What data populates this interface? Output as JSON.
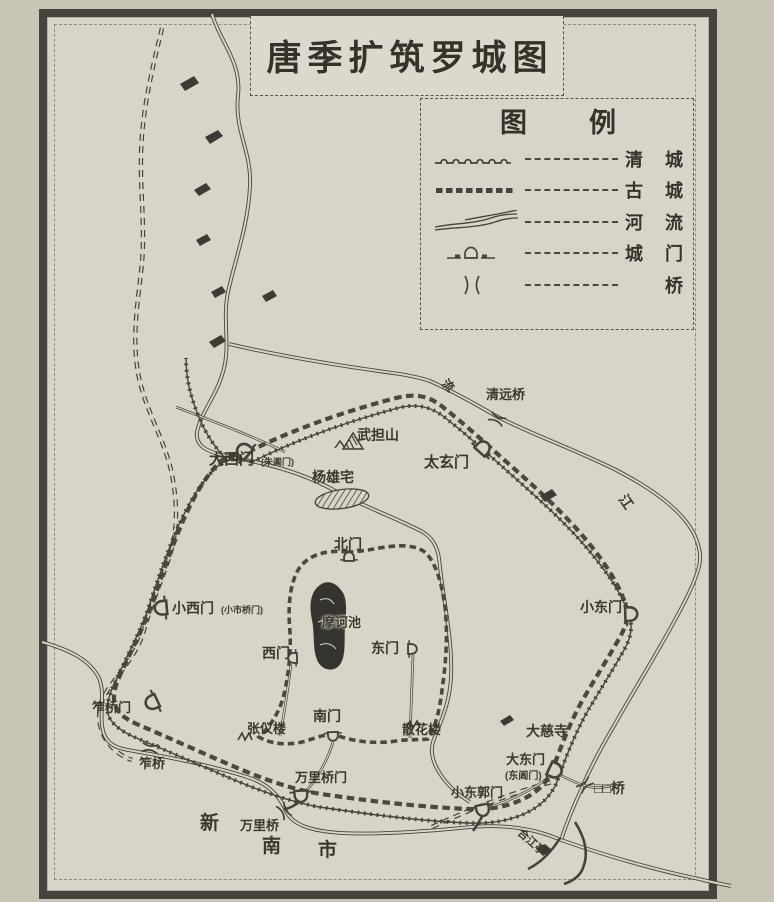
{
  "page_title": "唐季扩筑罗城图",
  "legend": {
    "title": "图例",
    "items": [
      {
        "symbol": "qing-wall-line",
        "label": "清城"
      },
      {
        "symbol": "ancient-wall-line",
        "label": "古城"
      },
      {
        "symbol": "river-line",
        "label": "河流"
      },
      {
        "symbol": "city-gate-symbol",
        "label": "城门"
      },
      {
        "symbol": "bridge-symbol",
        "label": "桥"
      }
    ]
  },
  "map": {
    "labels": [
      {
        "text": "清远桥",
        "x": 486,
        "y": 388,
        "size": 13
      },
      {
        "text": "武担山",
        "x": 357,
        "y": 428,
        "size": 14
      },
      {
        "text": "大西门",
        "x": 209,
        "y": 452,
        "size": 15
      },
      {
        "text": "(朱阊门)",
        "x": 261,
        "y": 458,
        "size": 9
      },
      {
        "text": "太玄门",
        "x": 424,
        "y": 455,
        "size": 15
      },
      {
        "text": "杨雄宅",
        "x": 312,
        "y": 470,
        "size": 14
      },
      {
        "text": "北门",
        "x": 334,
        "y": 537,
        "size": 14
      },
      {
        "text": "小西门",
        "x": 172,
        "y": 601,
        "size": 14
      },
      {
        "text": "(小市桥门)",
        "x": 221,
        "y": 606,
        "size": 9
      },
      {
        "text": "小东门",
        "x": 580,
        "y": 600,
        "size": 14
      },
      {
        "text": "摩诃池",
        "x": 322,
        "y": 616,
        "size": 13,
        "cls": "on-dark"
      },
      {
        "text": "西门",
        "x": 262,
        "y": 646,
        "size": 14
      },
      {
        "text": "东门",
        "x": 371,
        "y": 641,
        "size": 14
      },
      {
        "text": "笮桥门",
        "x": 92,
        "y": 701,
        "size": 13
      },
      {
        "text": "张仪楼",
        "x": 247,
        "y": 722,
        "size": 13
      },
      {
        "text": "南门",
        "x": 313,
        "y": 709,
        "size": 14
      },
      {
        "text": "散花楼",
        "x": 402,
        "y": 723,
        "size": 13
      },
      {
        "text": "大慈寺",
        "x": 526,
        "y": 724,
        "size": 14
      },
      {
        "text": "笮桥",
        "x": 139,
        "y": 757,
        "size": 13
      },
      {
        "text": "万里桥门",
        "x": 295,
        "y": 771,
        "size": 13
      },
      {
        "text": "大东门",
        "x": 506,
        "y": 753,
        "size": 13
      },
      {
        "text": "(东阊门)",
        "x": 505,
        "y": 771,
        "size": 10
      },
      {
        "text": "小东郭门",
        "x": 451,
        "y": 786,
        "size": 13
      },
      {
        "text": "□□桥",
        "x": 594,
        "y": 781,
        "size": 14
      },
      {
        "text": "新",
        "x": 200,
        "y": 814,
        "size": 19
      },
      {
        "text": "万里桥",
        "x": 240,
        "y": 819,
        "size": 13
      },
      {
        "text": "南",
        "x": 262,
        "y": 837,
        "size": 19
      },
      {
        "text": "市",
        "x": 318,
        "y": 841,
        "size": 19
      },
      {
        "text": "江",
        "x": 628,
        "y": 492,
        "size": 14,
        "rot": 55
      },
      {
        "text": "流",
        "x": 448,
        "y": 377,
        "size": 12,
        "rot": 45
      },
      {
        "text": "合江亭",
        "x": 523,
        "y": 827,
        "size": 11,
        "rot": 42
      }
    ]
  },
  "colors": {
    "ink": "#45433b",
    "paper": "#d8d4c7",
    "page_background": "#c8c4b6",
    "pond_fill": "#35332d"
  }
}
